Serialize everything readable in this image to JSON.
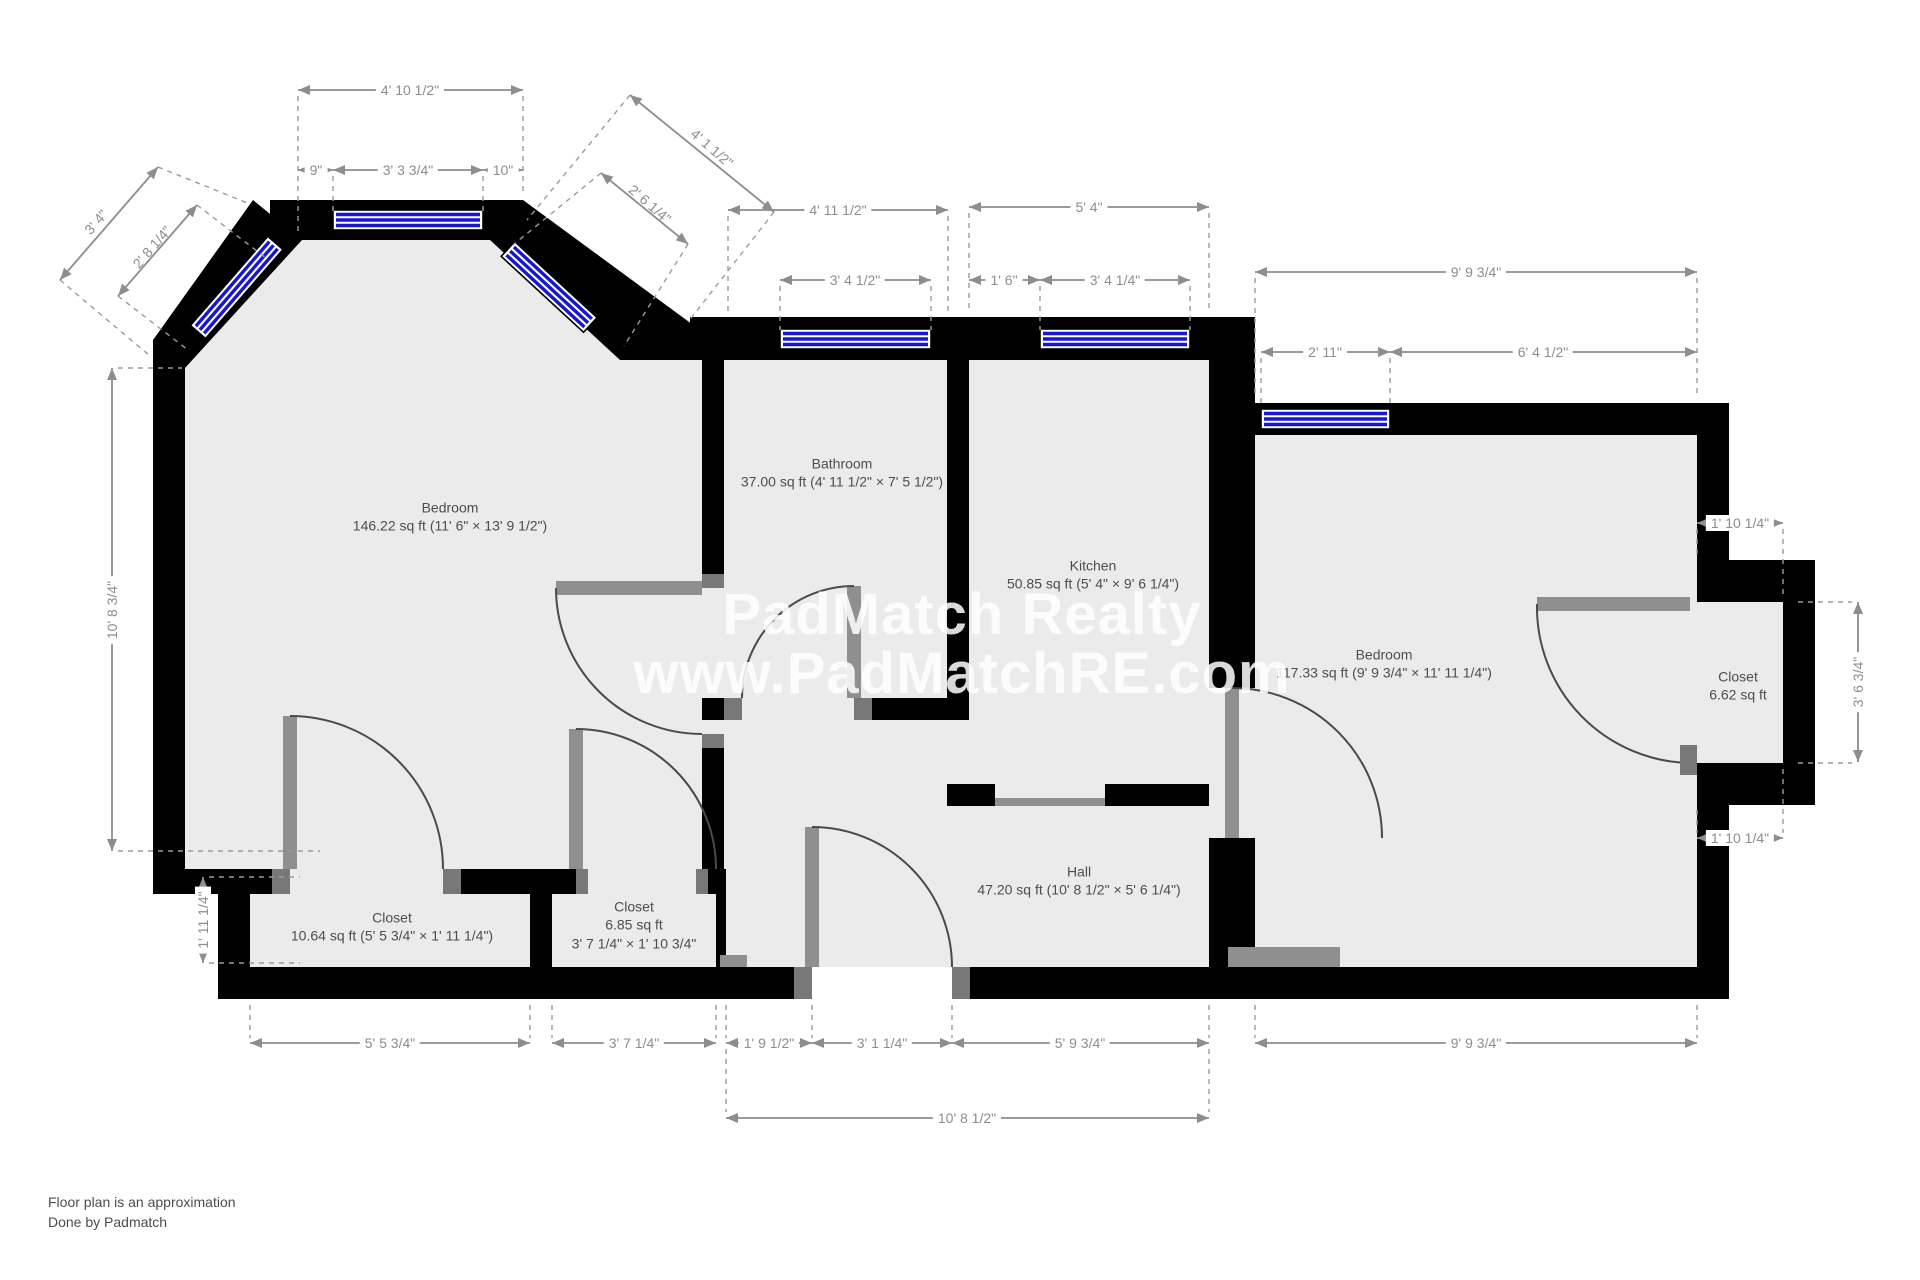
{
  "watermark": {
    "line1": "PadMatch Realty",
    "line2": "www.PadMatchRE.com"
  },
  "footer": {
    "line1": "Floor plan is an approximation",
    "line2": "Done by Padmatch"
  },
  "colors": {
    "wall": "#000000",
    "floor": "#ebebeb",
    "window_glass": "#1717cf",
    "dimension": "#8d8d8d",
    "door": "#4a4a4a",
    "watermark": "#ffffff"
  },
  "rooms": {
    "bedroom1": {
      "name": "Bedroom",
      "area": "146.22 sq ft (11' 6\" × 13' 9 1/2\")"
    },
    "bathroom": {
      "name": "Bathroom",
      "area": "37.00 sq ft (4' 11 1/2\" × 7' 5 1/2\")"
    },
    "kitchen": {
      "name": "Kitchen",
      "area": "50.85 sq ft (5' 4\" × 9' 6 1/4\")"
    },
    "bedroom2": {
      "name": "Bedroom",
      "area": "117.33 sq ft (9' 9 3/4\" × 11' 11 1/4\")"
    },
    "closet_right": {
      "name": "Closet",
      "area": "6.62 sq ft"
    },
    "hall": {
      "name": "Hall",
      "area": "47.20 sq ft (10' 8 1/2\" × 5' 6 1/4\")"
    },
    "closet_left": {
      "name": "Closet",
      "area": "10.64 sq ft (5' 5 3/4\" × 1' 11 1/4\")"
    },
    "closet_mid": {
      "name": "Closet",
      "area": "6.85 sq ft",
      "area2": "3' 7 1/4\" × 1' 10 3/4\""
    }
  },
  "dim_labels": {
    "bay_total": "4' 10 1/2\"",
    "bay_left": "9\"",
    "bay_window": "3' 3 3/4\"",
    "bay_right": "10\"",
    "diag_left_wall": "3' 4\"",
    "diag_left_window": "2' 8 1/4\"",
    "diag_right_wall": "4' 1 1/2\"",
    "diag_right_window": "2' 6 1/4\"",
    "bath_width": "4' 11 1/2\"",
    "bath_window": "3' 4 1/2\"",
    "kitchen_width": "5' 4\"",
    "kitchen_left": "1' 6\"",
    "kitchen_window": "3' 4 1/4\"",
    "bed2_width_top": "9' 9 3/4\"",
    "bed2_window": "2' 11\"",
    "bed2_wall_right": "6' 4 1/2\"",
    "bed1_height": "10' 8 3/4\"",
    "closet_left_height": "1' 11 1/4\"",
    "closet_right_depth_top": "1' 10 1/4\"",
    "closet_right_height": "3' 6 3/4\"",
    "closet_right_depth_bottom": "1' 10 1/4\"",
    "closet_left_width": "5' 5 3/4\"",
    "closet_mid_width": "3' 7 1/4\"",
    "vestibule_width": "1' 9 1/2\"",
    "entry_width": "3' 1 1/4\"",
    "hall_right_width": "5' 9 3/4\"",
    "bed2_width_bottom": "9' 9 3/4\"",
    "hall_total_width": "10' 8 1/2\""
  }
}
